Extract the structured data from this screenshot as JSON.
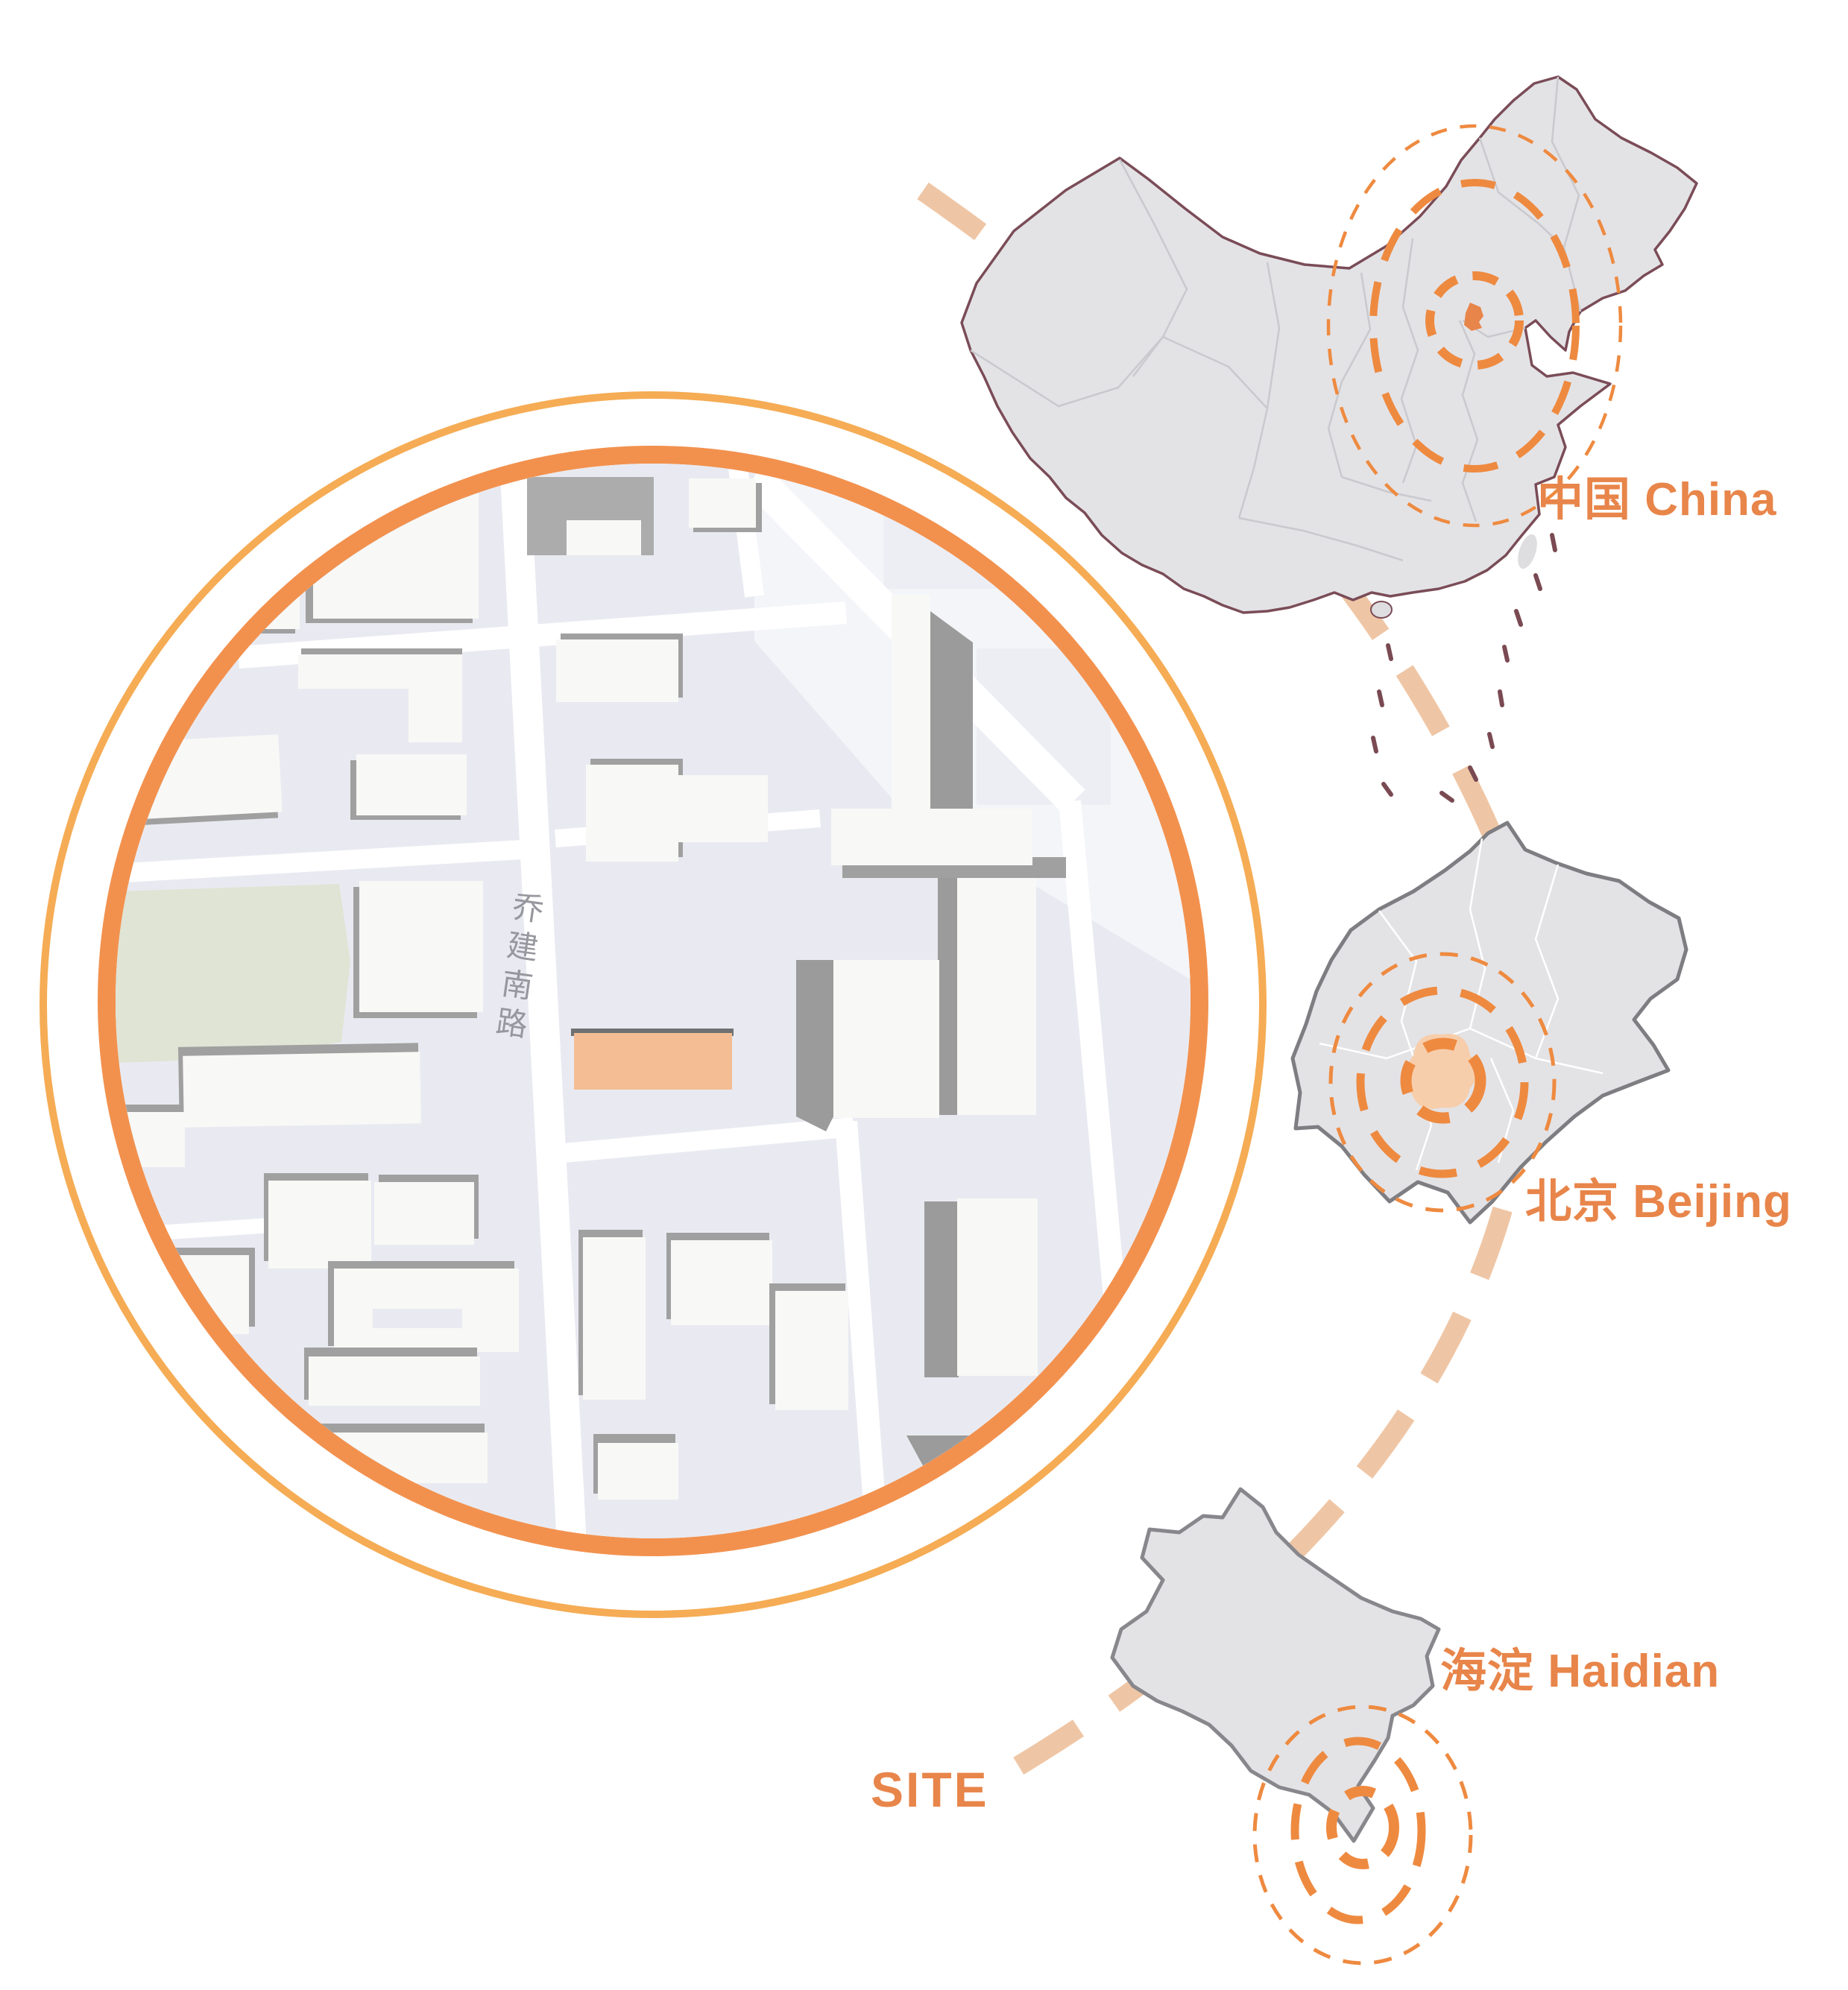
{
  "labels": {
    "china": "中国 China",
    "beijing": "北京 Beijing",
    "haidian": "海淀 Haidian",
    "site": "SITE",
    "street_name": "乔建南路"
  },
  "colors": {
    "accent_text": "#E8854A",
    "target_ring": "#EE8A40",
    "site_ring_inner": "#F2914E",
    "site_ring_outer": "#F5AC55",
    "connector_dash": "#EFC6A5",
    "country_fill": "#E3E3E6",
    "country_border": "#7A4C57",
    "province_line": "#C9C9CE",
    "municipality_border": "#7E7E82",
    "district_border": "#87878C",
    "nine_dash_line": "#7A4A52",
    "site_map_background": "#E9EAF1",
    "street": "#FFFFFF",
    "building": "#F8F8F6",
    "building_shadow": "#A0A0A0",
    "park": "#DFE4D5",
    "site_building": "#F4BD94",
    "beijing_highlight": "#E8854A",
    "urban_core_highlight": "#F7CEAC"
  }
}
